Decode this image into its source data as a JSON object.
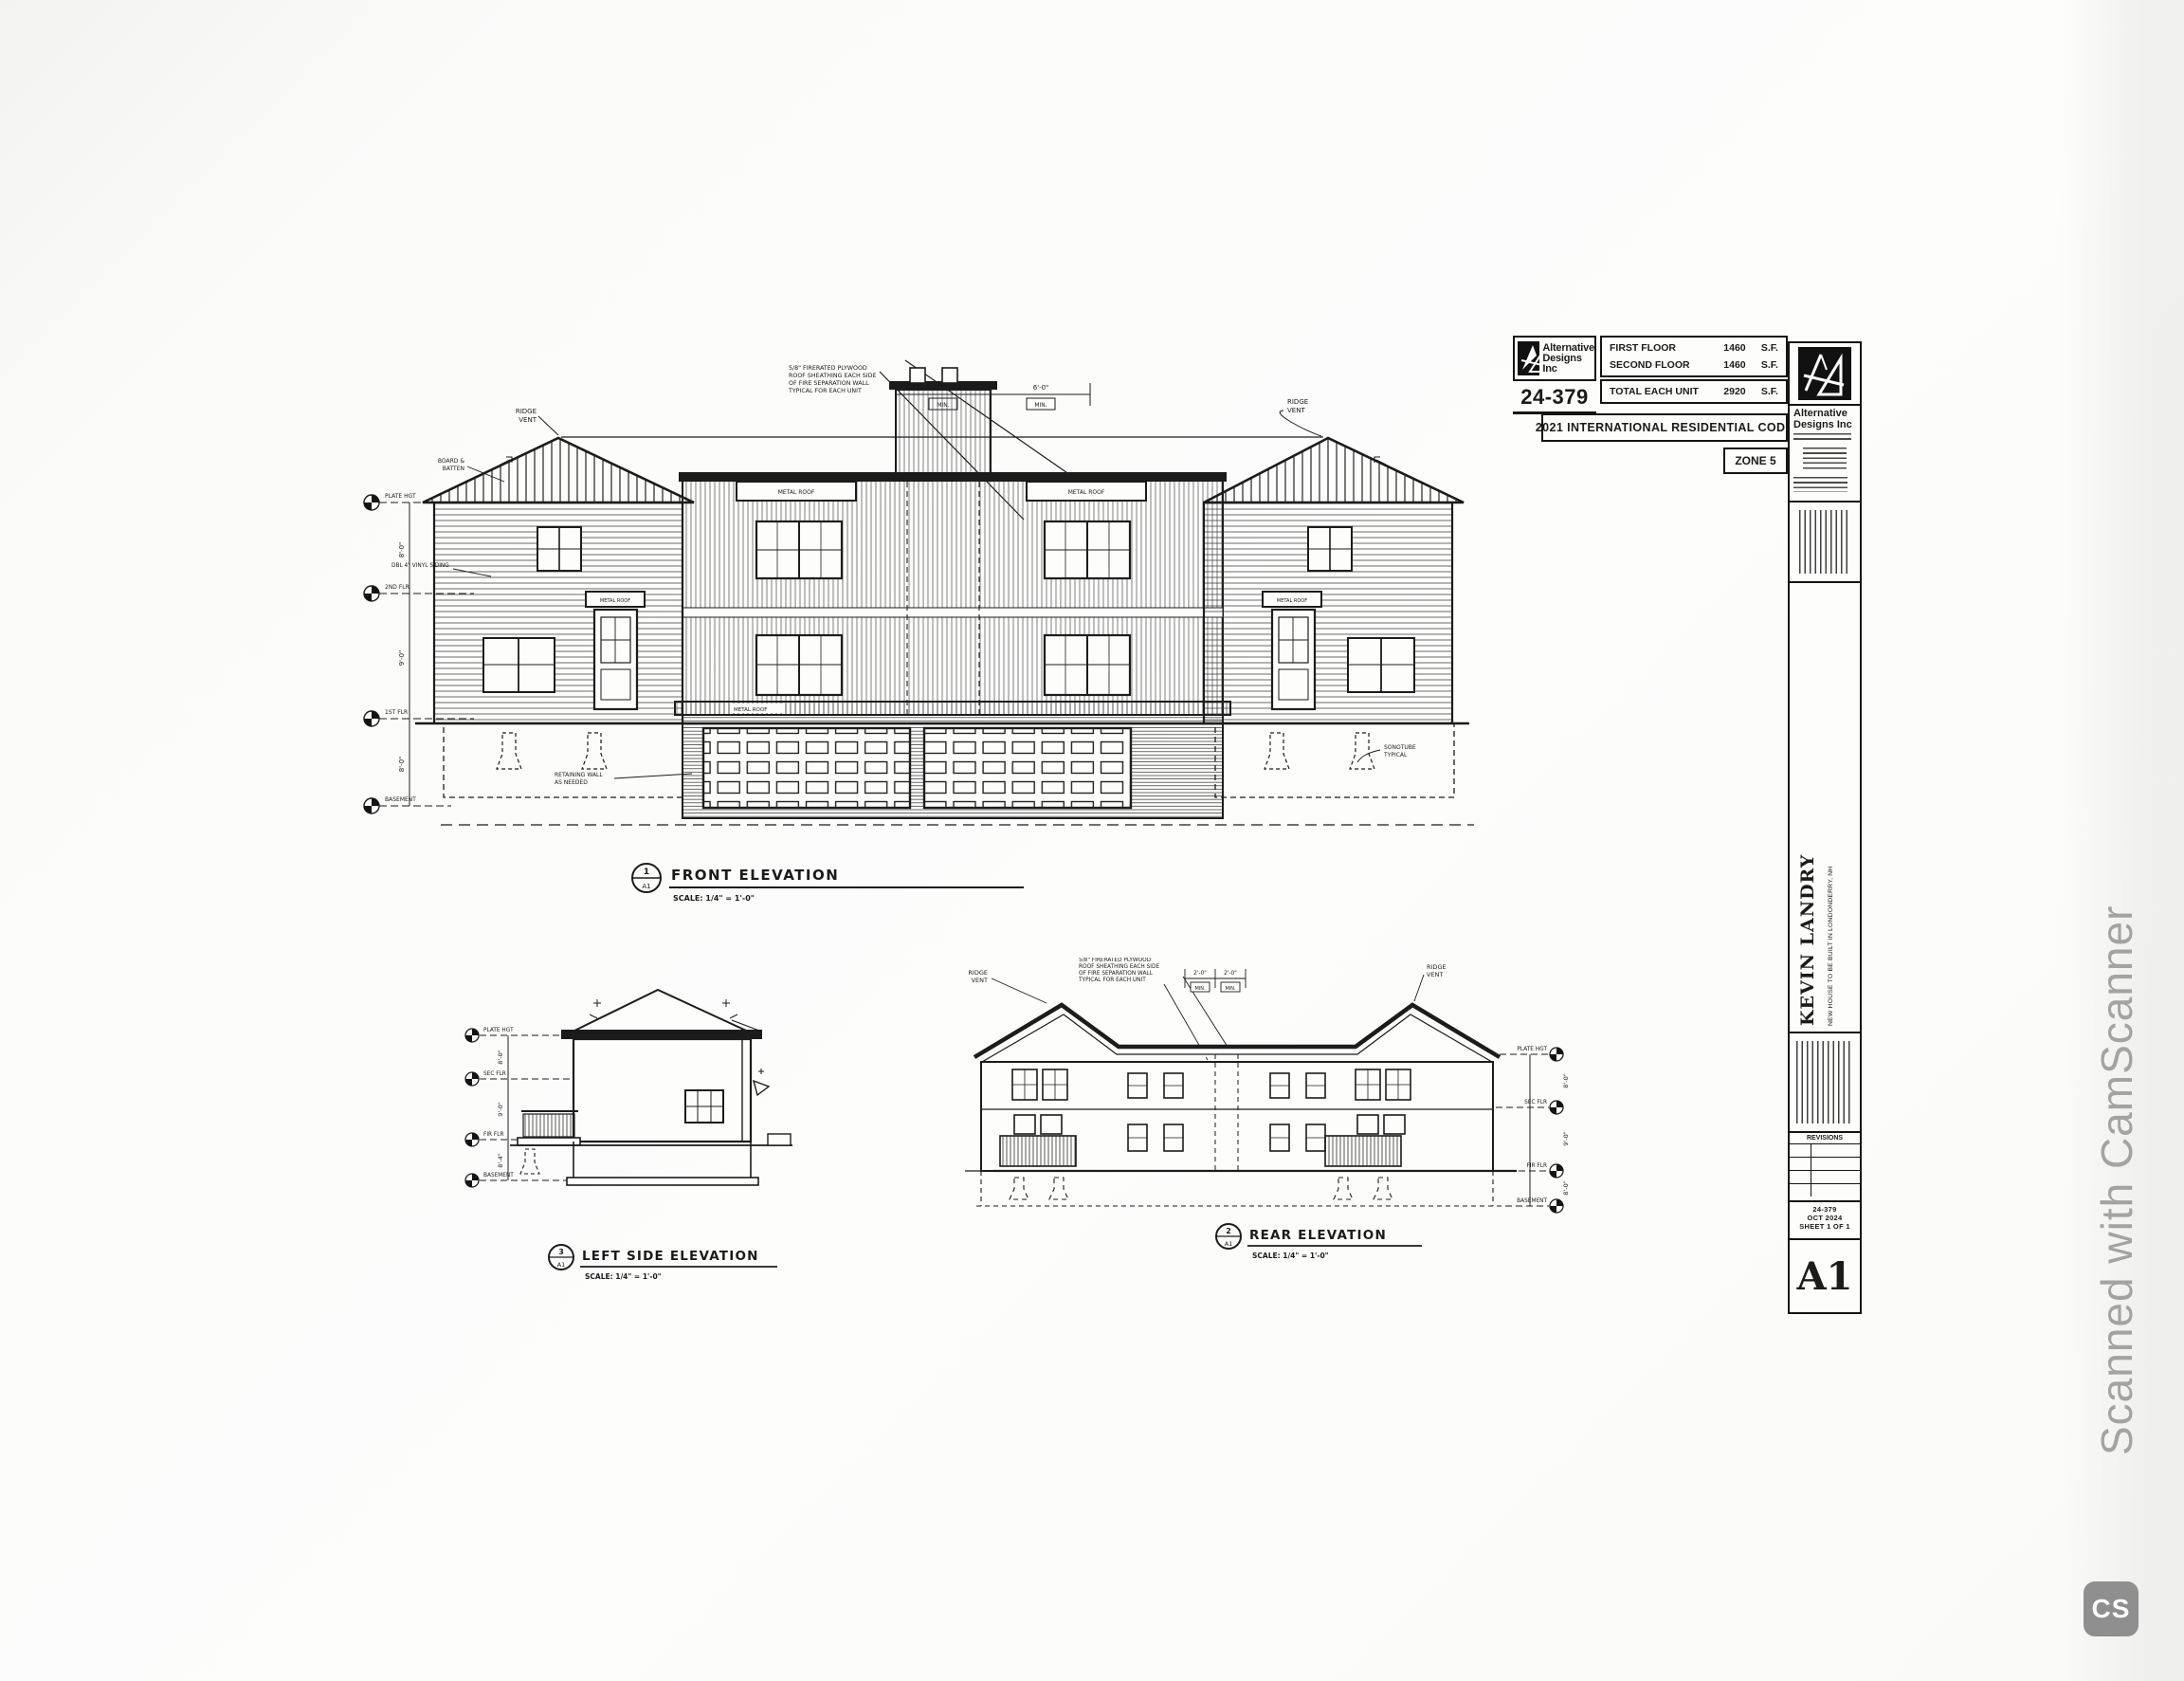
{
  "page": {
    "scan_brand": "Scanned with CamScanner",
    "scan_badge": "CS"
  },
  "info_block": {
    "firm_line1": "Alternative",
    "firm_line2": "Designs Inc",
    "project_no": "24-379",
    "areas": [
      {
        "label": "FIRST FLOOR",
        "value": "1460",
        "unit": "S.F."
      },
      {
        "label": "SECOND FLOOR",
        "value": "1460",
        "unit": "S.F."
      },
      {
        "label": "TOTAL EACH UNIT",
        "value": "2920",
        "unit": "S.F."
      }
    ],
    "code": "2021 INTERNATIONAL RESIDENTIAL CODE",
    "zone": "ZONE 5"
  },
  "titleblock": {
    "firm_line1": "Alternative",
    "firm_line2": "Designs Inc",
    "client": "KEVIN LANDRY",
    "project": "NEW HOUSE TO BE BUILT IN LONDONDERRY, NH",
    "revisions_label": "REVISIONS",
    "job_no": "24-379",
    "date": "OCT 2024",
    "sheet": "SHEET 1 OF 1",
    "sheet_no": "A1"
  },
  "front": {
    "ref": "1",
    "ref_sheet": "A1",
    "title": "FRONT ELEVATION",
    "scale": "SCALE: 1/4\" = 1'-0\"",
    "levels": [
      "PLATE HGT",
      "2ND FLR",
      "1ST FLR",
      "BASEMENT"
    ],
    "dims": [
      "8'-0\"",
      "9'-0\"",
      "8'-0\""
    ],
    "notes": {
      "ridge_vent": [
        "RIDGE",
        "VENT"
      ],
      "board_batten": [
        "BOARD &",
        "BATTEN"
      ],
      "vinyl": "DBL 4\" VINYL SIDING",
      "metal_roof": "METAL ROOF",
      "fire": [
        "5/8\" FIRERATED PLYWOOD",
        "ROOF SHEATHING EACH SIDE",
        "OF FIRE SEPARATION WALL",
        "TYPICAL FOR EACH UNIT"
      ],
      "dim_a": "2'-0\"",
      "dim_b": "6'-0\"",
      "min": "MIN.",
      "retaining": [
        "RETAINING WALL",
        "AS NEEDED"
      ],
      "sonotube": [
        "SONOTUBE",
        "TYPICAL"
      ]
    }
  },
  "side": {
    "ref": "3",
    "ref_sheet": "A1",
    "title": "LEFT SIDE ELEVATION",
    "scale": "SCALE: 1/4\" = 1'-0\"",
    "levels": [
      "PLATE HGT",
      "SEC FLR",
      "FIR FLR",
      "BASEMENT"
    ],
    "dims": [
      "8'-0\"",
      "9'-0\"",
      "8'-4\""
    ]
  },
  "rear": {
    "ref": "2",
    "ref_sheet": "A1",
    "title": "REAR ELEVATION",
    "scale": "SCALE: 1/4\" = 1'-0\"",
    "levels": [
      "PLATE HGT",
      "SEC FLR",
      "FIR FLR",
      "BASEMENT"
    ],
    "dims": [
      "8'-0\"",
      "9'-0\"",
      "8'-0\""
    ],
    "notes": {
      "ridge_vent": [
        "RIDGE",
        "VENT"
      ],
      "fire": [
        "5/8\" FIRERATED PLYWOOD",
        "ROOF SHEATHING EACH SIDE",
        "OF FIRE SEPARATION WALL",
        "TYPICAL FOR EACH UNIT"
      ],
      "dim_a": "2'-0\"",
      "dim_b": "2'-0\"",
      "min": "MIN."
    }
  }
}
